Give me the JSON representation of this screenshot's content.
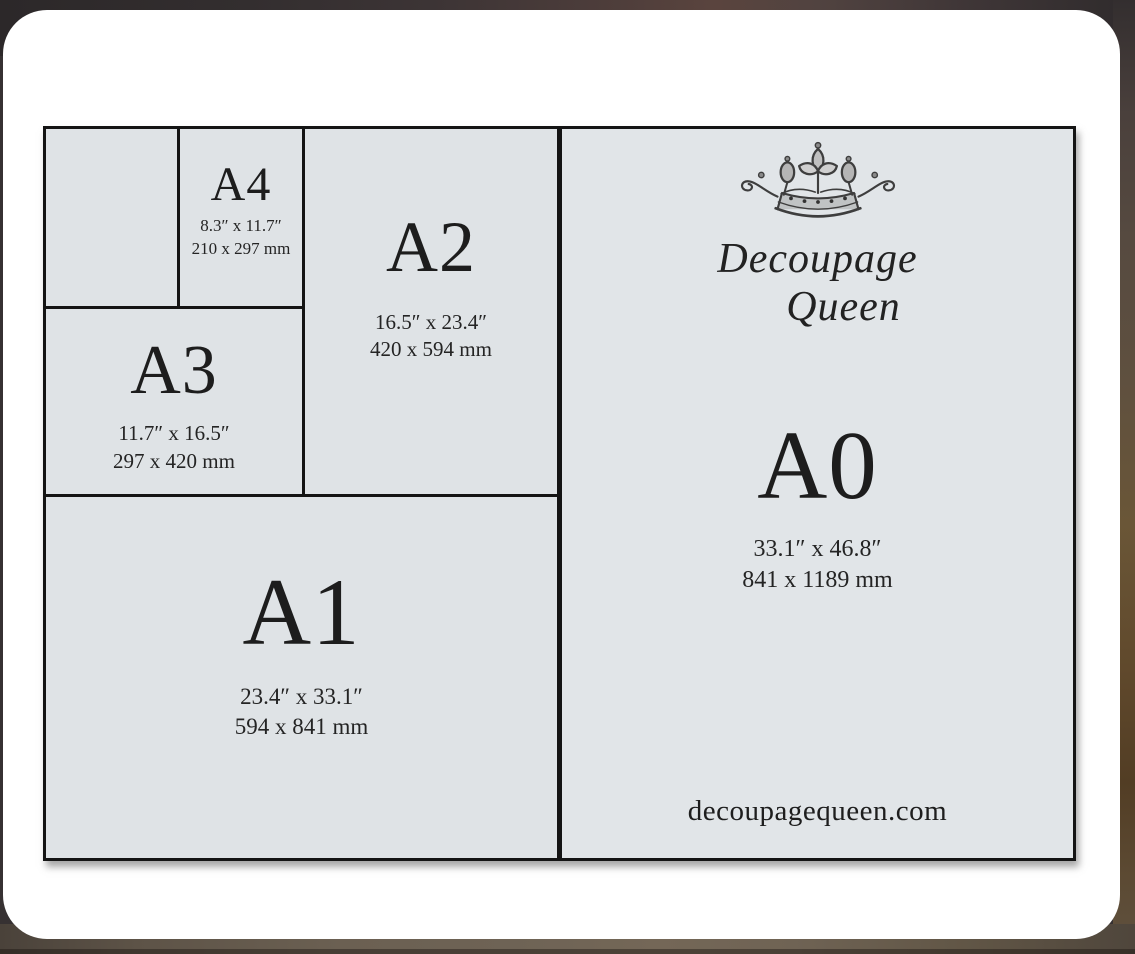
{
  "diagram": {
    "papers": [
      {
        "id": "a5",
        "label": "",
        "inches": "",
        "mm": ""
      },
      {
        "id": "a4",
        "label": "A4",
        "inches": "8.3″ x 11.7″",
        "mm": "210 x 297 mm"
      },
      {
        "id": "a3",
        "label": "A3",
        "inches": "11.7″ x 16.5″",
        "mm": "297 x 420 mm"
      },
      {
        "id": "a2",
        "label": "A2",
        "inches": "16.5″ x 23.4″",
        "mm": "420 x 594 mm"
      },
      {
        "id": "a1",
        "label": "A1",
        "inches": "23.4″ x 33.1″",
        "mm": "594 x 841 mm"
      },
      {
        "id": "a0",
        "label": "A0",
        "inches": "33.1″ x 46.8″",
        "mm": "841 x 1189 mm"
      }
    ],
    "brand": {
      "line1": "Decoupage",
      "line2": "Queen",
      "website": "decoupagequeen.com",
      "logo_icon": "crown-icon"
    },
    "colors": {
      "paper_fill": "#dfe3e6",
      "a0_fill": "#e1e5e8",
      "line": "#141414",
      "text": "#1d1d1d",
      "card": "#ffffff",
      "background_top": "#363132",
      "background_bottom": "#6e6355",
      "background_right": "#6a5637"
    }
  }
}
